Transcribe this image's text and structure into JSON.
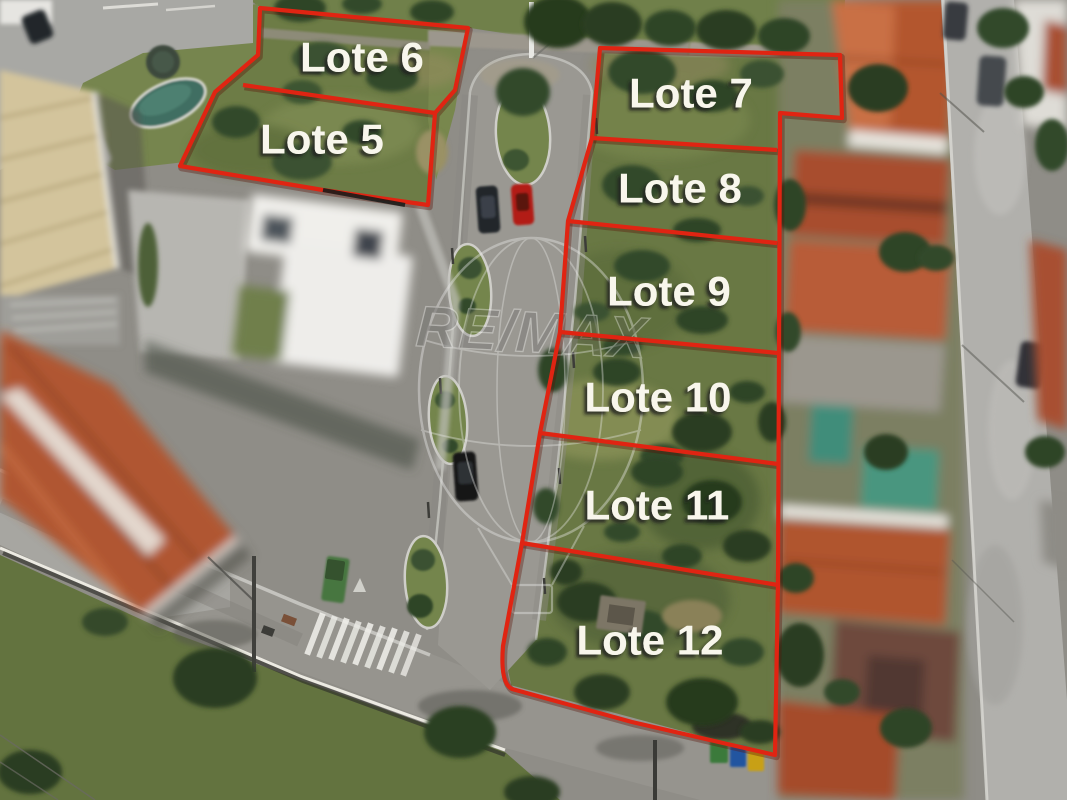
{
  "watermark": {
    "text": "RE/MAX"
  },
  "annotations": {
    "stroke_color": "#e02412",
    "stroke_shadow_color": "#5a0e04",
    "label_color": "#f8f6ec",
    "label_font_size": 42,
    "groups": [
      {
        "name": "lots-5-6",
        "outline": "M260,8 L468,28 L455,90 L435,113 L428,205 L323,190 L180,166 L215,92 L258,55 Z",
        "dividers": [
          "M243,85 L435,113"
        ]
      },
      {
        "name": "lots-7-12",
        "outline": "M600,48 L840,55 L842,118 L780,113 L778,583 L775,755 L632,722 L512,689 Q500,683 503,646 L522,543 L540,433 L560,332 L568,221 L592,138 Z",
        "dividers": [
          "M592,138 L777,150",
          "M568,221 L777,243",
          "M560,332 L778,353",
          "M540,433 L778,464",
          "M522,543 L778,585"
        ]
      }
    ],
    "labels": [
      {
        "text": "Lote 5",
        "x": 322,
        "y": 139
      },
      {
        "text": "Lote 6",
        "x": 362,
        "y": 57
      },
      {
        "text": "Lote 7",
        "x": 691,
        "y": 93
      },
      {
        "text": "Lote 8",
        "x": 680,
        "y": 188
      },
      {
        "text": "Lote 9",
        "x": 669,
        "y": 291
      },
      {
        "text": "Lote 10",
        "x": 658,
        "y": 397
      },
      {
        "text": "Lote 11",
        "x": 657,
        "y": 505
      },
      {
        "text": "Lote 12",
        "x": 650,
        "y": 640
      }
    ]
  }
}
